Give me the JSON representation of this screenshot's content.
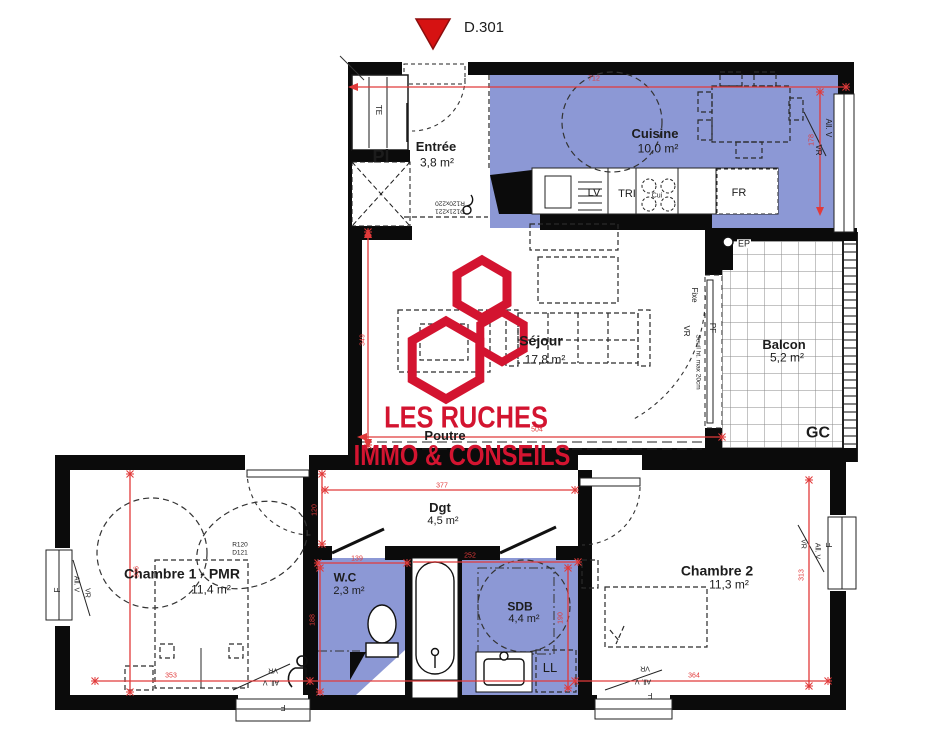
{
  "marker": {
    "label": "D.301"
  },
  "logo": {
    "line1": "LES RUCHES",
    "line2": "IMMO & CONSEILS",
    "color": "#d31430"
  },
  "colors": {
    "room_fill": "#8c98d5",
    "dimension": "#e13a3a",
    "wall": "#0b0b0b",
    "logo_red": "#d31430",
    "marker_red": "#d61212"
  },
  "rooms": {
    "entree": {
      "name": "Entrée",
      "area": "3,8 m²"
    },
    "cuisine": {
      "name": "Cuisine",
      "area": "10,0 m²"
    },
    "sejour": {
      "name": "Séjour",
      "area": "17,8 m²"
    },
    "balcon": {
      "name": "Balcon",
      "area": "5,2 m²"
    },
    "dgt": {
      "name": "Dgt",
      "area": "4,5 m²"
    },
    "chambre1": {
      "name": "Chambre 1 - PMR",
      "area": "11,4 m²"
    },
    "wc": {
      "name": "W.C",
      "area": "2,3 m²"
    },
    "sdb": {
      "name": "SDB",
      "area": "4,4 m²"
    },
    "chambre2": {
      "name": "Chambre 2",
      "area": "11,3 m²"
    }
  },
  "equipment": {
    "te": "TE",
    "pl": "Pl",
    "lv": "LV",
    "tri": "TRI",
    "cui": "Cui",
    "fr": "FR",
    "ep": "EP",
    "gc": "GC",
    "ll": "LL",
    "poutre": "Poutre"
  },
  "openings": {
    "vr": "VR",
    "all_v": "All. V",
    "f": "F",
    "fixe": "Fixe",
    "pf": "PF",
    "seuil": "Seuil ht. max 20cm"
  },
  "door_specs": {
    "entree_line1": "R120x220",
    "entree_line2": "D121x221",
    "ch1_line1": "R120",
    "ch1_line2": "D121"
  },
  "dims": {
    "top": "712",
    "kitchen_right": "178",
    "sejour_left": "349",
    "sejour_bottom": "504",
    "dgt_top": "377",
    "dgt_left": "120",
    "ch1_left": "336",
    "ch1_bottom": "353",
    "wc_top": "139",
    "wc_left": "188",
    "sdb_top": "252",
    "sdb_right": "190",
    "ch2_right": "313",
    "ch2_bottom": "364"
  }
}
